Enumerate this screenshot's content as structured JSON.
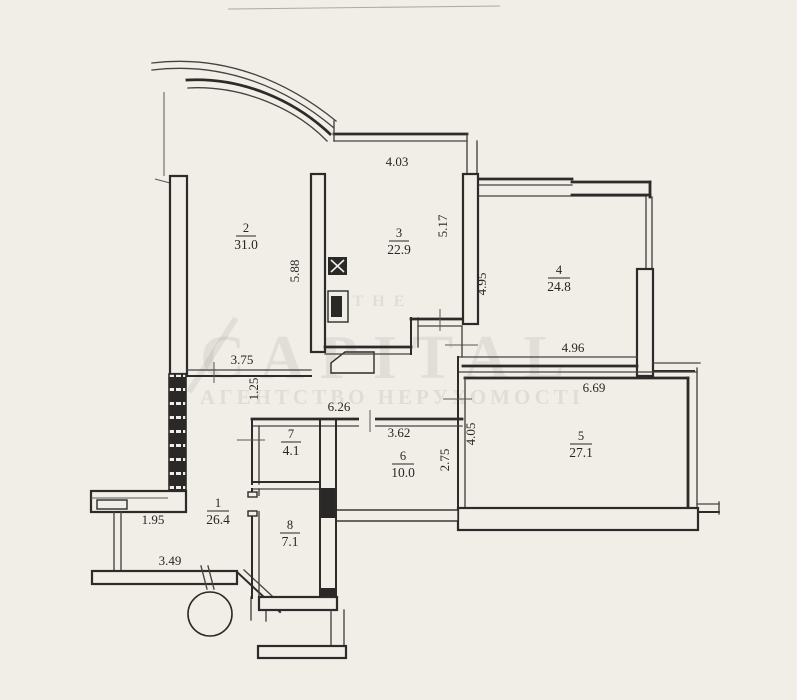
{
  "plan": {
    "type": "apartment-floor-plan",
    "paper_color": "#f1eee8",
    "ink_color": "#2c2b29",
    "watermark_color": "#8e877a"
  },
  "watermark": {
    "prefix": "THE",
    "brand": "CAPITAL",
    "tagline": "АГЕНТСТВО НЕРУХОМОСТІ"
  },
  "rooms": {
    "r1": {
      "number": "1",
      "area": "26.4"
    },
    "r2": {
      "number": "2",
      "area": "31.0"
    },
    "r3": {
      "number": "3",
      "area": "22.9"
    },
    "r4": {
      "number": "4",
      "area": "24.8"
    },
    "r5": {
      "number": "5",
      "area": "27.1"
    },
    "r6": {
      "number": "6",
      "area": "10.0"
    },
    "r7": {
      "number": "7",
      "area": "4.1"
    },
    "r8": {
      "number": "8",
      "area": "7.1"
    }
  },
  "dimensions": {
    "room3_top": "4.03",
    "room3_right_v": "5.17",
    "room3_left_v": "5.88",
    "room4_left_v": "4.95",
    "room4_bottom": "4.96",
    "room5_top": "6.69",
    "room5_left_v": "4.05",
    "room6_right_v": "2.75",
    "room6_top": "3.62",
    "hall_top": "6.26",
    "hall_upper": "3.75",
    "hall_upper_v": "1.25",
    "hall_left": "1.95",
    "hall_bottom": "3.49"
  }
}
